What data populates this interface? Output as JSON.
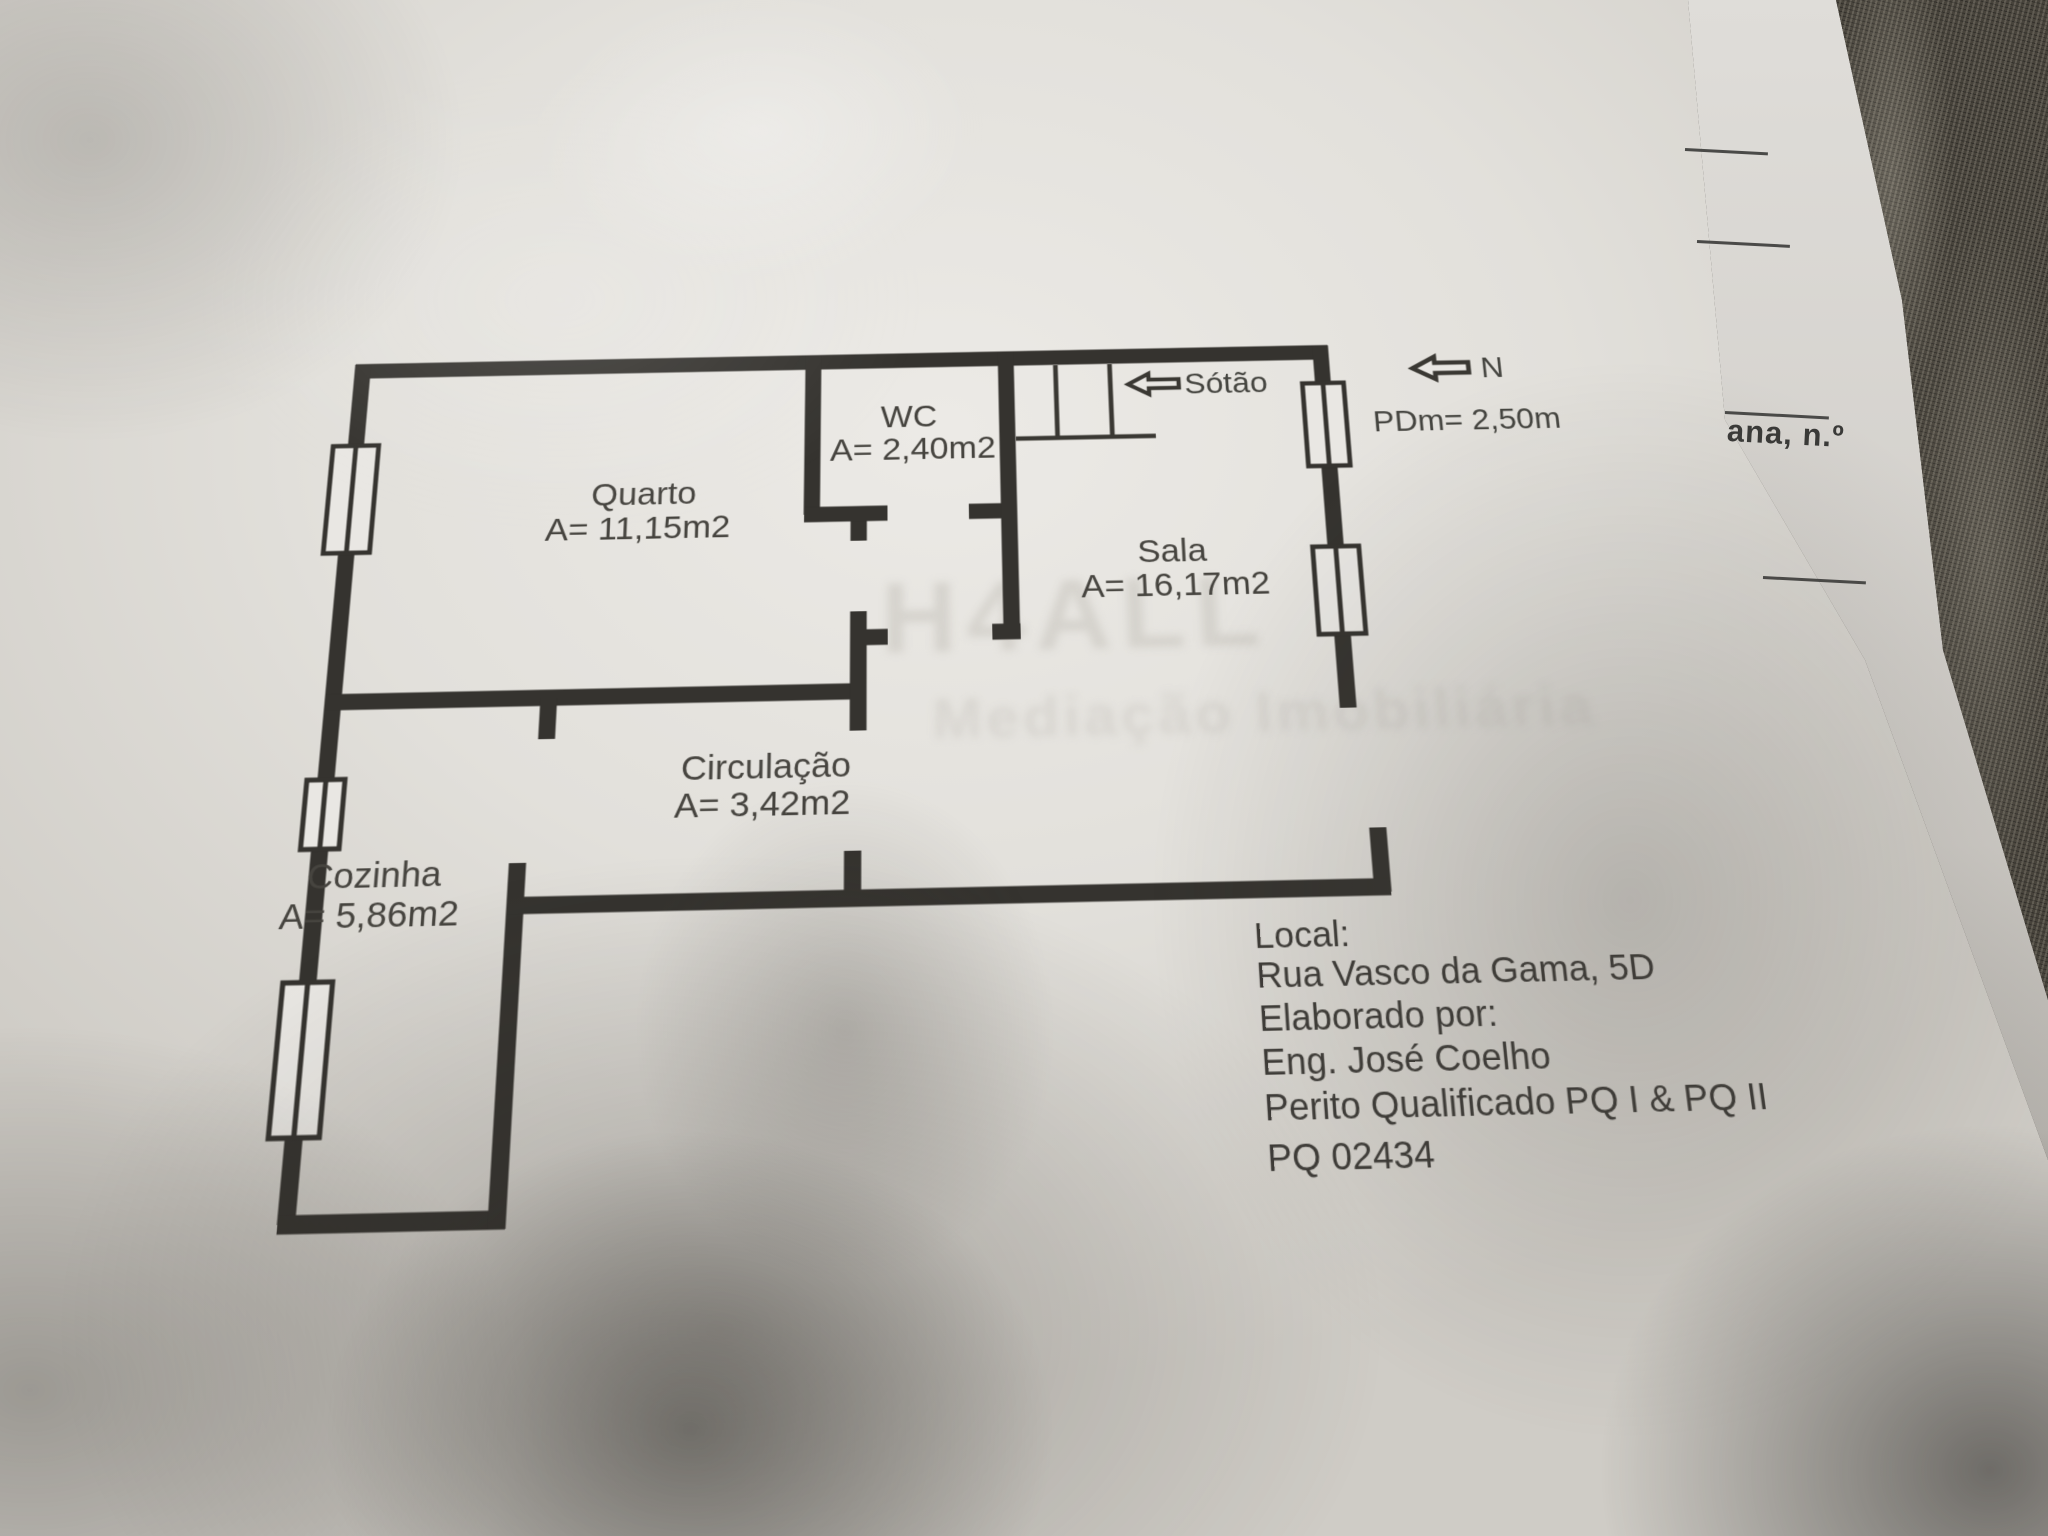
{
  "floor_plan": {
    "rooms": [
      {
        "id": "quarto",
        "label": "Quarto",
        "area": "A= 11,15m2"
      },
      {
        "id": "wc",
        "label": "WC",
        "area": "A= 2,40m2"
      },
      {
        "id": "sala",
        "label": "Sala",
        "area": "A= 16,17m2"
      },
      {
        "id": "circulacao",
        "label": "Circulação",
        "area": "A= 3,42m2"
      },
      {
        "id": "cozinha",
        "label": "Cozinha",
        "area": "A= 5,86m2"
      }
    ],
    "annotations": {
      "attic_label": "Sótão",
      "north_label": "N",
      "ceiling_height": "PDm= 2,50m"
    },
    "info_block": {
      "lines": [
        "Local:",
        "Rua Vasco da Gama, 5D",
        "Elaborado por:",
        "Eng. José Coelho",
        "Perito Qualificado PQ I & PQ II",
        "PQ 02434"
      ]
    },
    "watermark": {
      "line1": "H4ALL",
      "line2": "Mediação Imobiliária"
    },
    "side_sheet": {
      "fragment": "ana, n.º"
    },
    "colors": {
      "ink": "#35332f",
      "paper": "#e6e4e0",
      "fabric": "#47433b"
    }
  }
}
